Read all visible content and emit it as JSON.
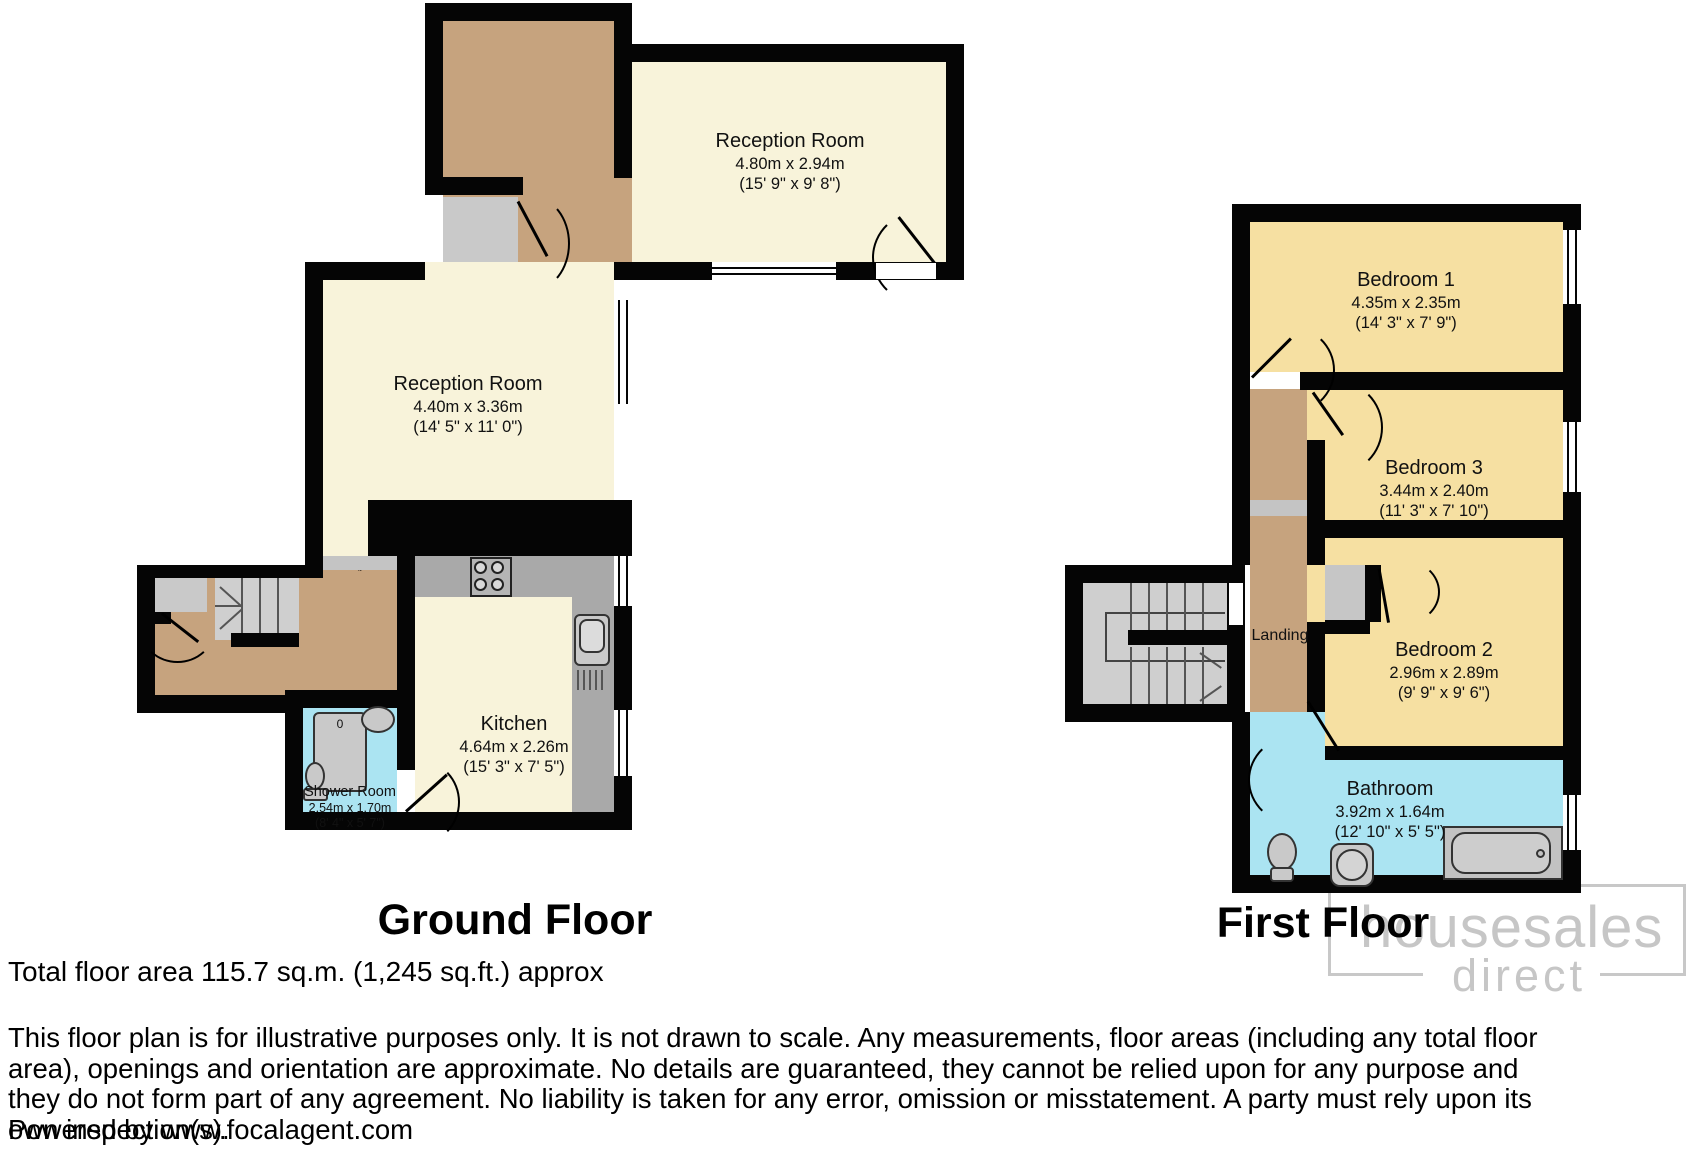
{
  "ground_floor": {
    "title": "Ground Floor",
    "rooms": {
      "reception_top": {
        "name": "Reception Room",
        "metric": "4.80m x 2.94m",
        "imperial": "(15' 9\" x 9' 8\")"
      },
      "reception_left": {
        "name": "Reception Room",
        "metric": "4.40m x 3.36m",
        "imperial": "(14' 5\" x 11' 0\")"
      },
      "kitchen": {
        "name": "Kitchen",
        "metric": "4.64m x 2.26m",
        "imperial": "(15' 3\" x 7' 5\")"
      },
      "shower_room": {
        "name": "Shower Room",
        "metric": "2.54m x 1.70m",
        "imperial": "(8' 4\" x 5' 7\")"
      }
    }
  },
  "first_floor": {
    "title": "First Floor",
    "rooms": {
      "bedroom1": {
        "name": "Bedroom 1",
        "metric": "4.35m x 2.35m",
        "imperial": "(14' 3\" x 7' 9\")"
      },
      "bedroom3": {
        "name": "Bedroom 3",
        "metric": "3.44m x 2.40m",
        "imperial": "(11' 3\" x 7' 10\")"
      },
      "bedroom2": {
        "name": "Bedroom 2",
        "metric": "2.96m x 2.89m",
        "imperial": "(9' 9\" x 9' 6\")"
      },
      "bathroom": {
        "name": "Bathroom",
        "metric": "3.92m x 1.64m",
        "imperial": "(12' 10\" x 5' 5\")"
      },
      "landing": {
        "name": "Landing"
      }
    }
  },
  "summary": {
    "total_area": "Total floor area 115.7 sq.m. (1,245 sq.ft.) approx"
  },
  "disclaimer": {
    "text": "This floor plan is for illustrative purposes only. It is not drawn to scale. Any measurements, floor areas (including any total floor area), openings and orientation are approximate. No details are guaranteed, they cannot be relied upon for any purpose and they do not form part of any agreement. No liability is taken for any error, omission or misstatement. A party must rely upon its own inspection(s).",
    "powered_by": "Powered by www.focalagent.com"
  },
  "watermark": {
    "line1": "housesales",
    "line2": "direct"
  },
  "fixtures": {
    "shower_tray_mark": "0"
  },
  "colors": {
    "wall": "#050505",
    "reception_cream": "#f8f3da",
    "bedroom_yellow": "#f6e0a2",
    "hall_tan": "#c6a37e",
    "wet_room_blue": "#abe4f2",
    "fixture_gray": "#c9c9c9",
    "watermark_gray": "#c6c6c6"
  }
}
